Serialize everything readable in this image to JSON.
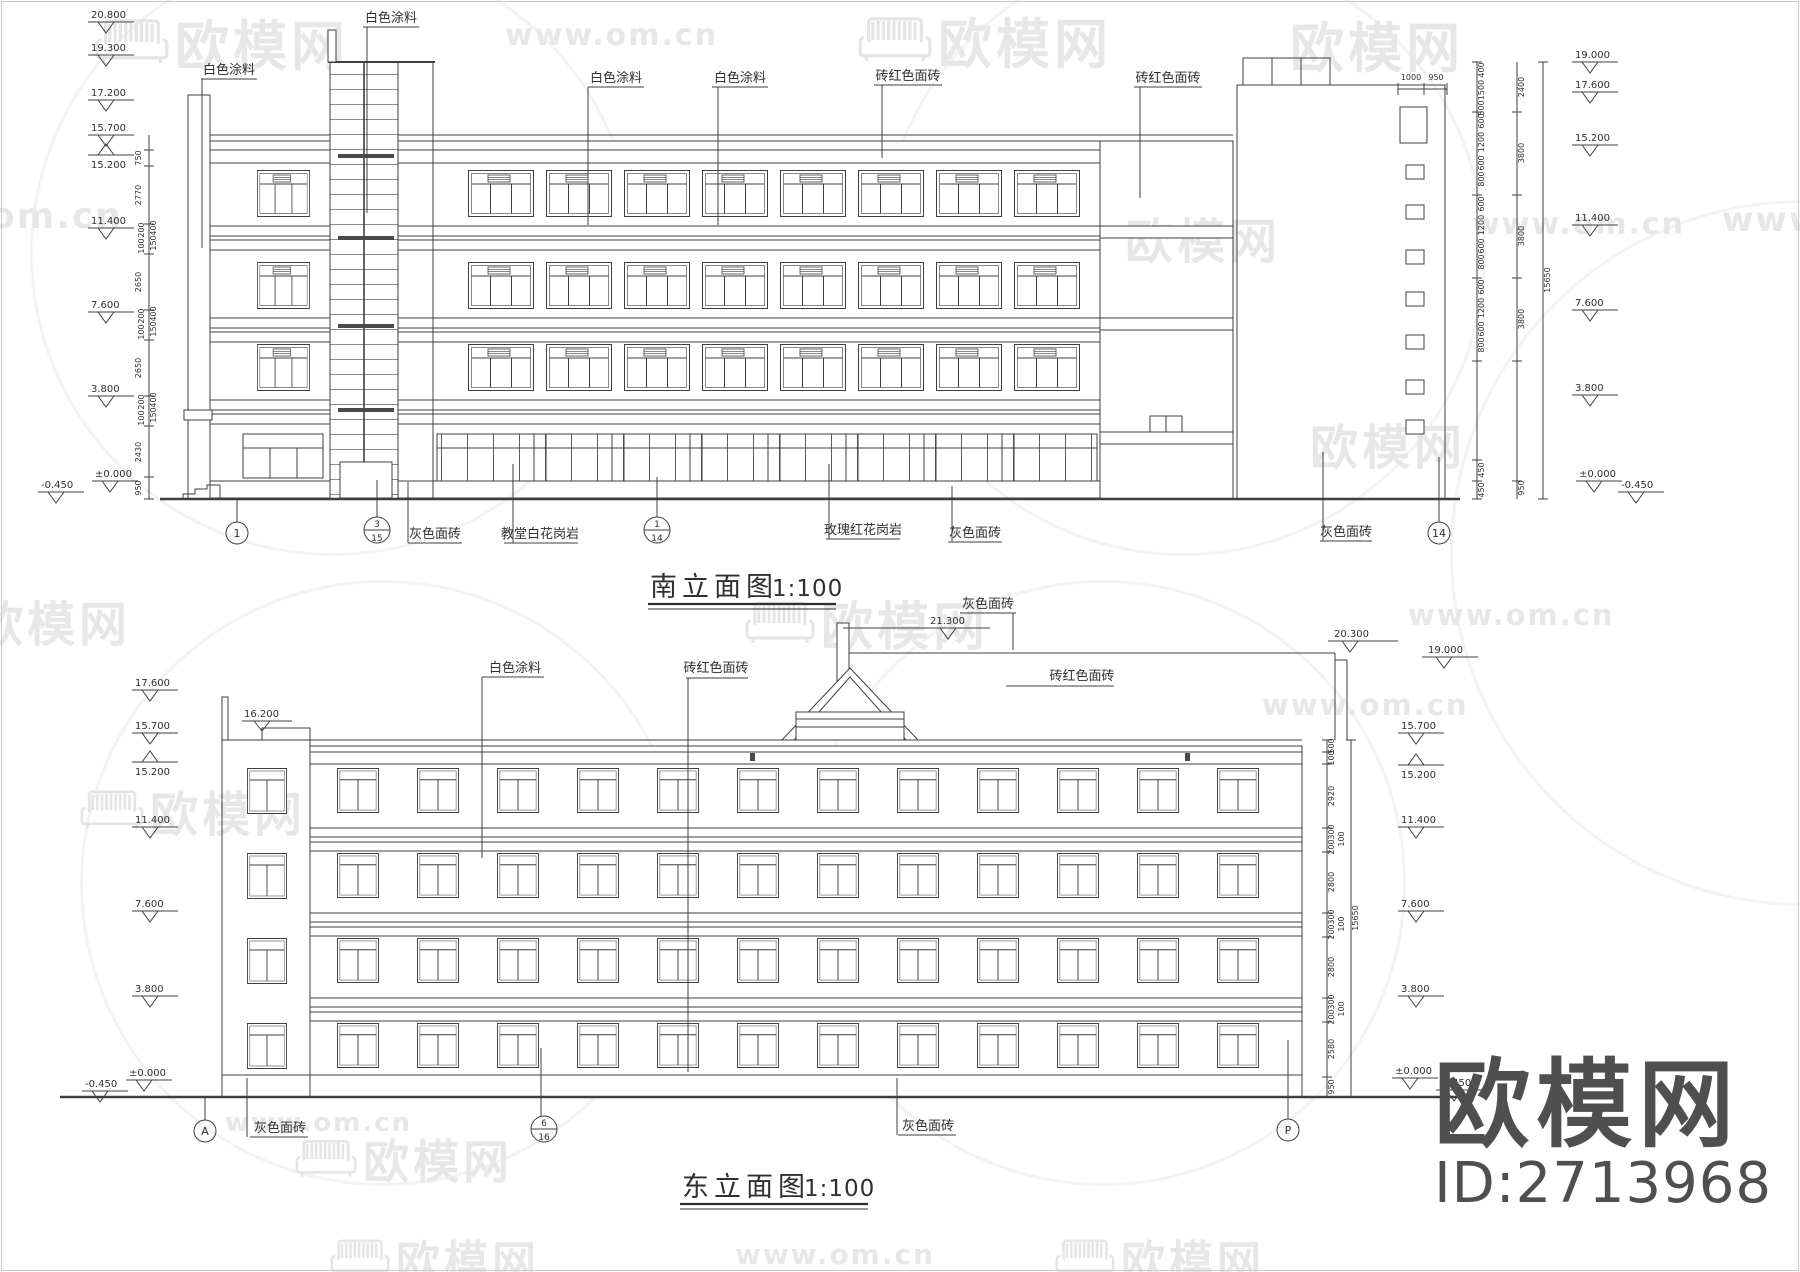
{
  "watermarks": {
    "brand": "欧模网",
    "url": "www.om.cn",
    "url_short": "om.cn",
    "www": "www.",
    "id_label": "ID:2713968"
  },
  "south": {
    "title": "南立面图",
    "scale": "1:100",
    "labels": {
      "paint1": "白色涂料",
      "paint2": "白色涂料",
      "paint3": "白色涂料",
      "paint4": "白色涂料",
      "redbrick1": "砖红色面砖",
      "redbrick2": "砖红色面砖",
      "grey1": "灰色面砖",
      "granite_white": "教堂白花岗岩",
      "granite_rose": "玫瑰红花岗岩",
      "grey2": "灰色面砖",
      "grey3": "灰色面砖"
    },
    "bubbles": {
      "b1": "1",
      "b2_top": "3",
      "b2_bottom": "15",
      "b3_top": "1",
      "b3_bottom": "14",
      "b4": "14"
    },
    "elev_left": [
      "20.800",
      "19.300",
      "17.200",
      "15.700",
      "15.200",
      "11.400",
      "7.600",
      "3.800",
      "±0.000",
      "-0.450"
    ],
    "elev_right": [
      "19.000",
      "17.600",
      "15.200",
      "11.400",
      "7.600",
      "3.800",
      "±0.000",
      "-0.450"
    ],
    "dims_left": [
      "750",
      "2770",
      "400",
      "200",
      "150",
      "100",
      "2650",
      "400",
      "200",
      "150",
      "100",
      "2650",
      "400",
      "200",
      "150",
      "100",
      "2430",
      "950"
    ],
    "dims_right_inner": [
      "400",
      "1500",
      "500",
      "600",
      "1200",
      "600",
      "800",
      "600",
      "1200",
      "600",
      "800",
      "600",
      "1200",
      "600",
      "800",
      "450",
      "450"
    ],
    "dims_right_outer": [
      "2400",
      "3800",
      "3800",
      "3800",
      "950"
    ],
    "dims_right_total": "15650",
    "dims_top": [
      "1000",
      "950"
    ]
  },
  "east": {
    "title": "东立面图",
    "scale": "1:100",
    "labels": {
      "paint1": "白色涂料",
      "redbrick_left": "砖红色面砖",
      "grey_top": "灰色面砖",
      "redbrick_right": "砖红色面砖",
      "grey_bottom1": "灰色面砖",
      "grey_bottom2": "灰色面砖"
    },
    "elev_top": [
      "21.300",
      "20.300",
      "19.000"
    ],
    "tower_elev": "16.200",
    "elev_left": [
      "17.600",
      "15.700",
      "15.200",
      "11.400",
      "7.600",
      "3.800",
      "±0.000",
      "-0.450"
    ],
    "elev_right": [
      "15.700",
      "15.200",
      "11.400",
      "7.600",
      "3.800",
      "±0.000",
      "-0.450"
    ],
    "dims_right": [
      "500",
      "100",
      "2920",
      "300",
      "100",
      "200",
      "2800",
      "300",
      "100",
      "200",
      "2800",
      "300",
      "100",
      "200",
      "2580",
      "950"
    ],
    "dims_right_total": "15650",
    "bubbles": {
      "a": "A",
      "b_top": "6",
      "b_bottom": "16",
      "p": "P"
    }
  }
}
